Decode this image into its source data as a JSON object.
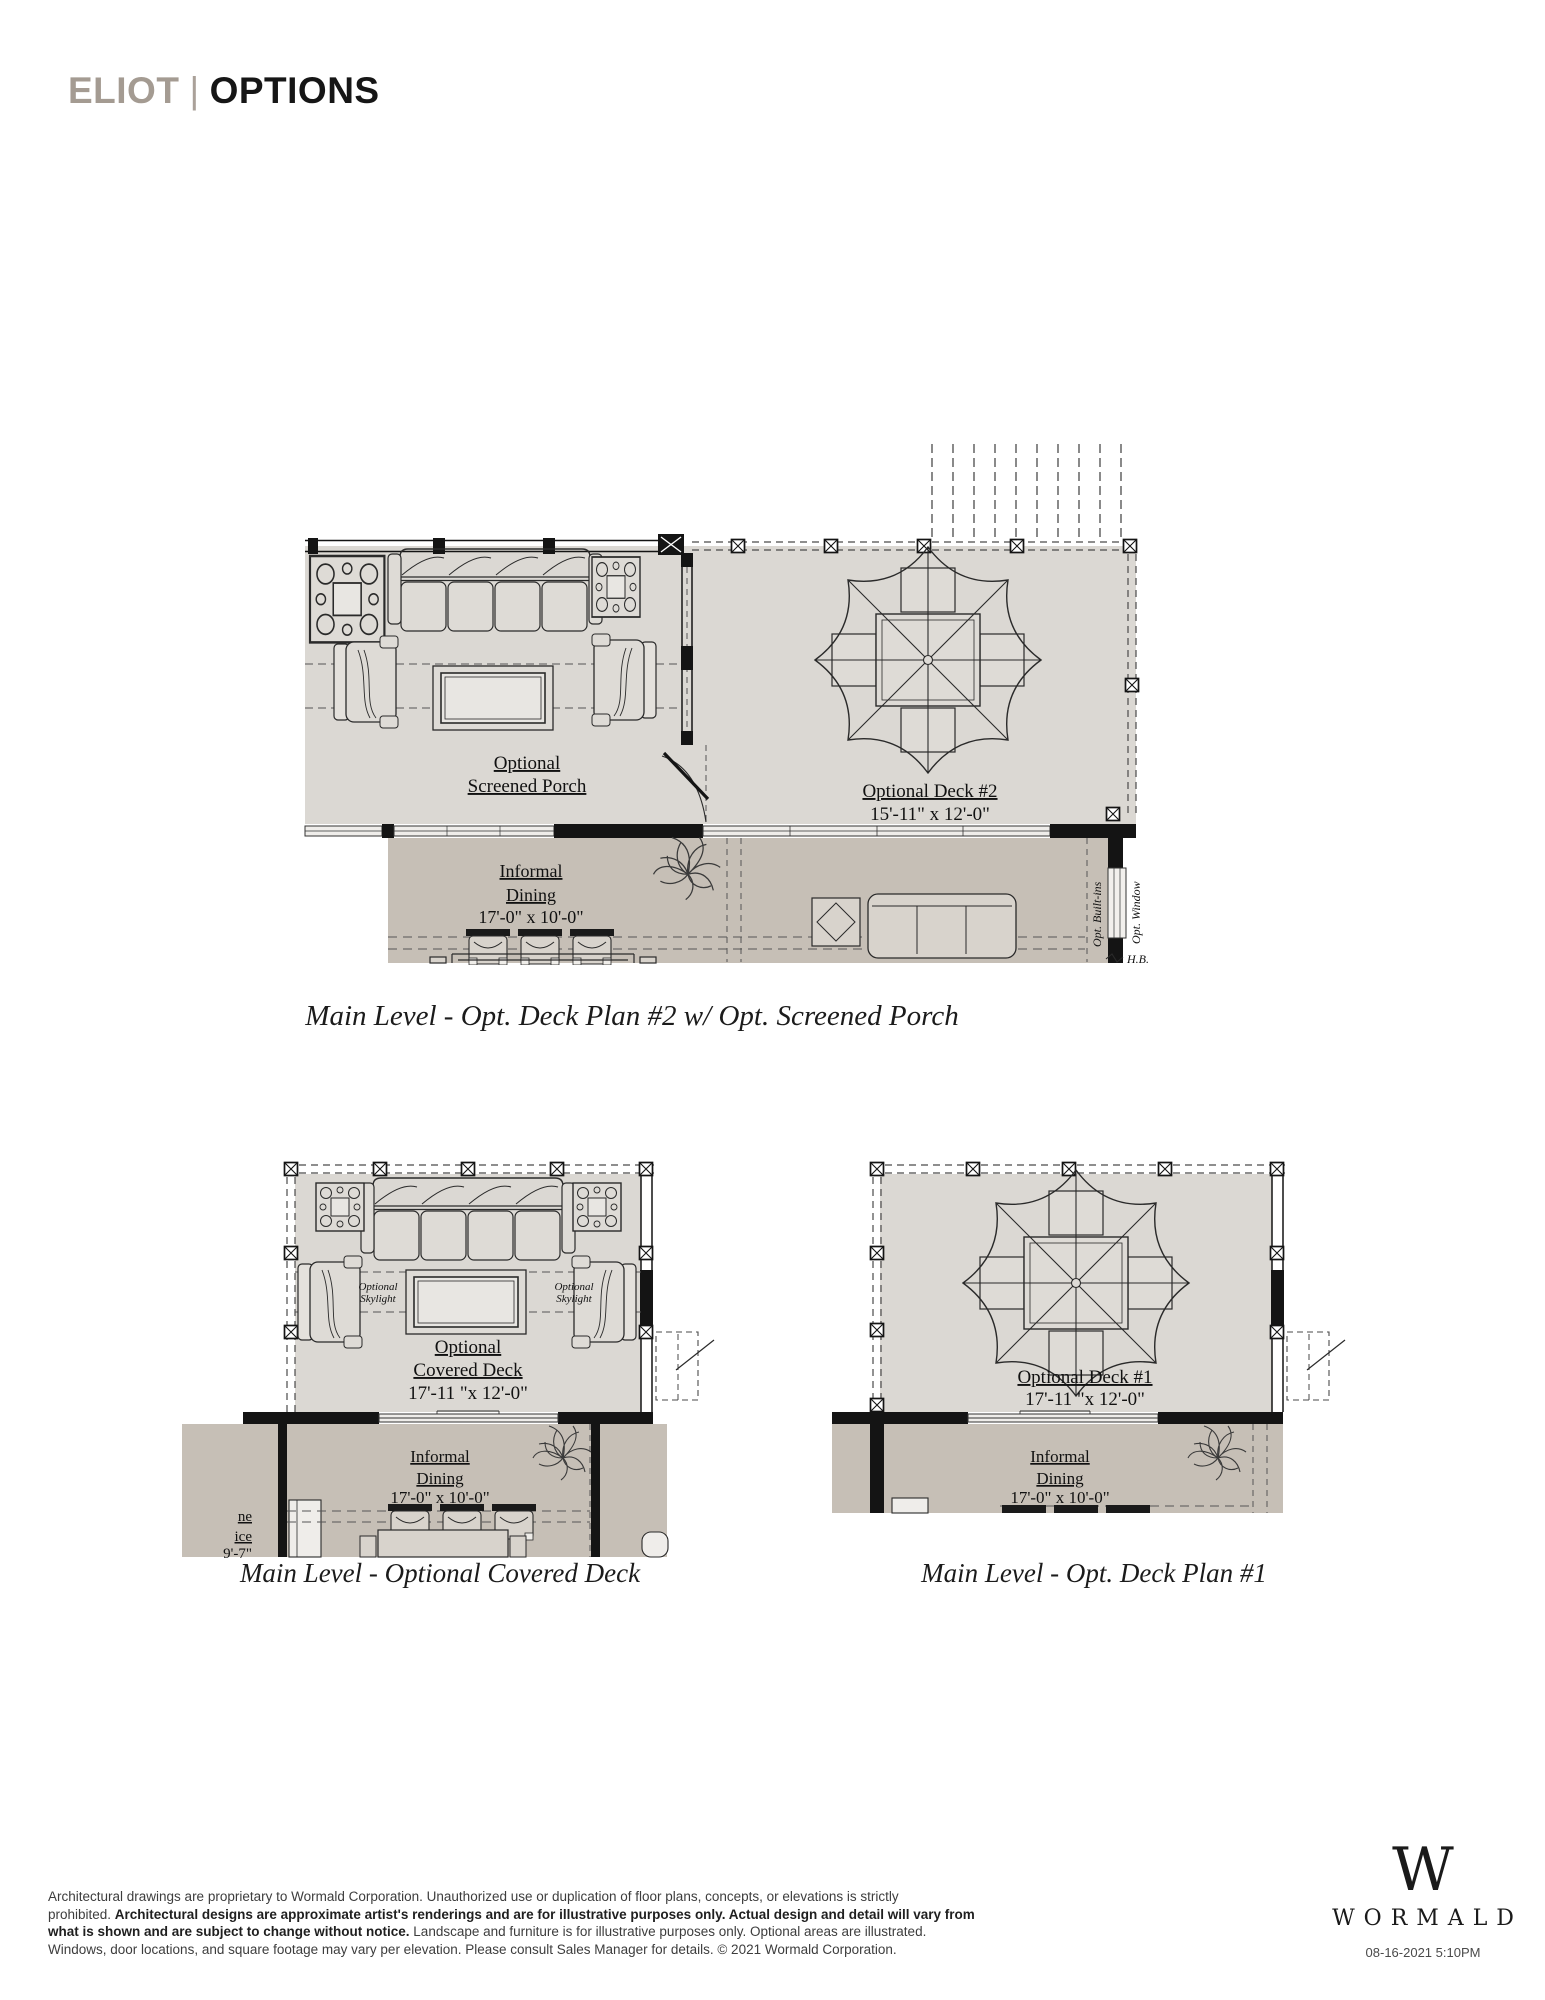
{
  "header": {
    "brand": "ELIOT",
    "divider": "|",
    "page": "OPTIONS"
  },
  "colors": {
    "brand_gray": "#a49b92",
    "ink": "#161616",
    "deck_floor": "#dbd8d3",
    "interior_floor": "#c6bfb6",
    "wall_black": "#141414"
  },
  "plans": {
    "plan2": {
      "caption": "Main Level - Opt. Deck Plan #2 w/ Opt. Screened Porch",
      "porch_label_1": "Optional",
      "porch_label_2": "Screened Porch",
      "deck_label": "Optional Deck #2",
      "deck_dims": "15'-11\" x 12'-0\"",
      "dining_1": "Informal",
      "dining_2": "Dining",
      "dining_dims": "17'-0\" x 10'-0\"",
      "opt_builtins": "Opt. Built-ins",
      "opt_window": "Opt. Window",
      "hose_bib": "H.B."
    },
    "covered": {
      "caption": "Main Level - Optional Covered Deck",
      "label_1": "Optional",
      "label_2": "Covered Deck",
      "dims": "17'-11 \"x 12'-0\"",
      "skylight_1": "Optional",
      "skylight_2": "Skylight",
      "dining_1": "Informal",
      "dining_2": "Dining",
      "dining_dims": "17'-0\" x 10'-0\"",
      "cut_text_1": "ne",
      "cut_text_2": "ice",
      "cut_text_3": "9'-7\""
    },
    "deck1": {
      "caption": "Main Level - Opt. Deck Plan #1",
      "label_1": "Optional Deck #1",
      "dims": "17'-11 \"x 12'-0\"",
      "dining_1": "Informal",
      "dining_2": "Dining",
      "dining_dims": "17'-0\" x 10'-0\""
    }
  },
  "footer": {
    "line1": "Architectural drawings are proprietary to Wormald Corporation. Unauthorized use or duplication of floor plans, concepts, or elevations is strictly",
    "line2_normal": "prohibited. ",
    "line2_bold": "Architectural designs are approximate artist's renderings and are for illustrative purposes only. Actual design and detail will vary from",
    "line3_bold": "what is shown and are subject to change without notice.",
    "line3_normal": " Landscape and furniture is for illustrative purposes only. Optional areas are illustrated.",
    "line4": "Windows, door locations, and square footage may vary per elevation. Please consult Sales Manager for details. © 2021 Wormald Corporation.",
    "logo_letter": "W",
    "logo_name": "WORMALD",
    "timestamp": "08-16-2021 5:10PM"
  }
}
